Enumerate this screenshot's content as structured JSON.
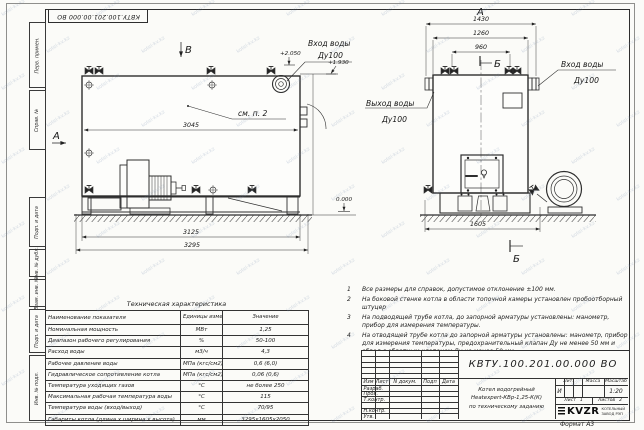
{
  "watermark": {
    "text": "kotel-kv.kz"
  },
  "stamp_top": "КВТУ.100.201.00.000 ВО",
  "margin_labels": [
    "Перв. примен.",
    "Справ. №",
    "Подп. и дата",
    "Инв. № дубл.",
    "Взам. инв. №",
    "Подп. и дата",
    "Инв. № подл."
  ],
  "side_view": {
    "view_label_top": "В",
    "view_label_left": "А",
    "see_note": "см. п. 2",
    "dim_3045": "3045",
    "dim_3125": "3125",
    "dim_3295": "3295",
    "level_2050": "+2.050",
    "level_1930": "+1.930",
    "level_0": "0.000",
    "inlet_line1": "Вход воды",
    "inlet_line2": "Ду100"
  },
  "front_view": {
    "view_label": "А",
    "section_label": "Б",
    "dim_1430": "1430",
    "dim_1260": "1260",
    "dim_960": "960",
    "dim_1605": "1605",
    "inlet_line1": "Вход воды",
    "inlet_line2": "Ду100",
    "outlet_line1": "Выход воды",
    "outlet_line2": "Ду100"
  },
  "notes": [
    {
      "num": "1",
      "text": "Все размеры для справок, допустимое отклонение ±100 мм."
    },
    {
      "num": "2",
      "text": "На боковой стенке котла в области топочной камеры установлен пробоотборный штуцер"
    },
    {
      "num": "3",
      "text": "На  подводящей трубе котла, до запорной арматуры установлены: манометр, прибор для измерения температуры."
    },
    {
      "num": "4",
      "text": "На отводящей трубе котла до запорной арматуры установлены: манометр, прибор для измерения температуры, предохранительный клапан Ду не менее 50 мм и обвод с обратным клапаном Ду не менее 50 мм."
    }
  ],
  "tech_table": {
    "title": "Техническая характеристика",
    "headers": [
      "Наименование показателя",
      "Единицы измерения",
      "Значение"
    ],
    "rows": [
      [
        "Номинальная мощность",
        "МВт",
        "1,25"
      ],
      [
        "Диапазон рабочего регулирования",
        "%",
        "50-100"
      ],
      [
        "Расход воды",
        "м3/ч",
        "4,3"
      ],
      [
        "Рабочее давление воды",
        "МПа (кгс/см2)",
        "0,6 (6,0)"
      ],
      [
        "Гидравлическое сопротивление котла",
        "МПа (кгс/см2)",
        "0,06 (0,6)"
      ],
      [
        "Температура уходящих газов",
        "°С",
        "не более 250"
      ],
      [
        "Максимальная рабочая температура воды",
        "°С",
        "115"
      ],
      [
        "Температура воды (вход/выход)",
        "°С",
        "70/95"
      ],
      [
        "Габариты котла (длина х ширина х высота)",
        "мм",
        "3295х1605х2050"
      ]
    ]
  },
  "title_block": {
    "doc_number": "КВТУ.100.201.00.000  ВО",
    "header_cols": [
      "Изм",
      "Лист",
      "N докум.",
      "Подп",
      "Дата"
    ],
    "row_labels": [
      "Разраб.",
      "Пров.",
      "Т.контр.",
      "",
      "Н.контр.",
      "Утв."
    ],
    "description": [
      "Котел водогрейный",
      "Heatexpert-КВр-1,25-К(К)",
      "по техническому заданию"
    ],
    "lit_header": "Лит.",
    "mass_header": "Масса",
    "scale_header": "Масштаб",
    "lit_value": "И",
    "scale_value": "1:20",
    "sheet_label": "Лист",
    "sheet_value": "1",
    "sheets_label": "Листов",
    "sheets_value": "2",
    "logo_text": "KVZR",
    "logo_sub1": "КОТЕЛЬНЫЙ",
    "logo_sub2": "ЗАВОД РЭП",
    "format_label": "Формат  А3"
  }
}
